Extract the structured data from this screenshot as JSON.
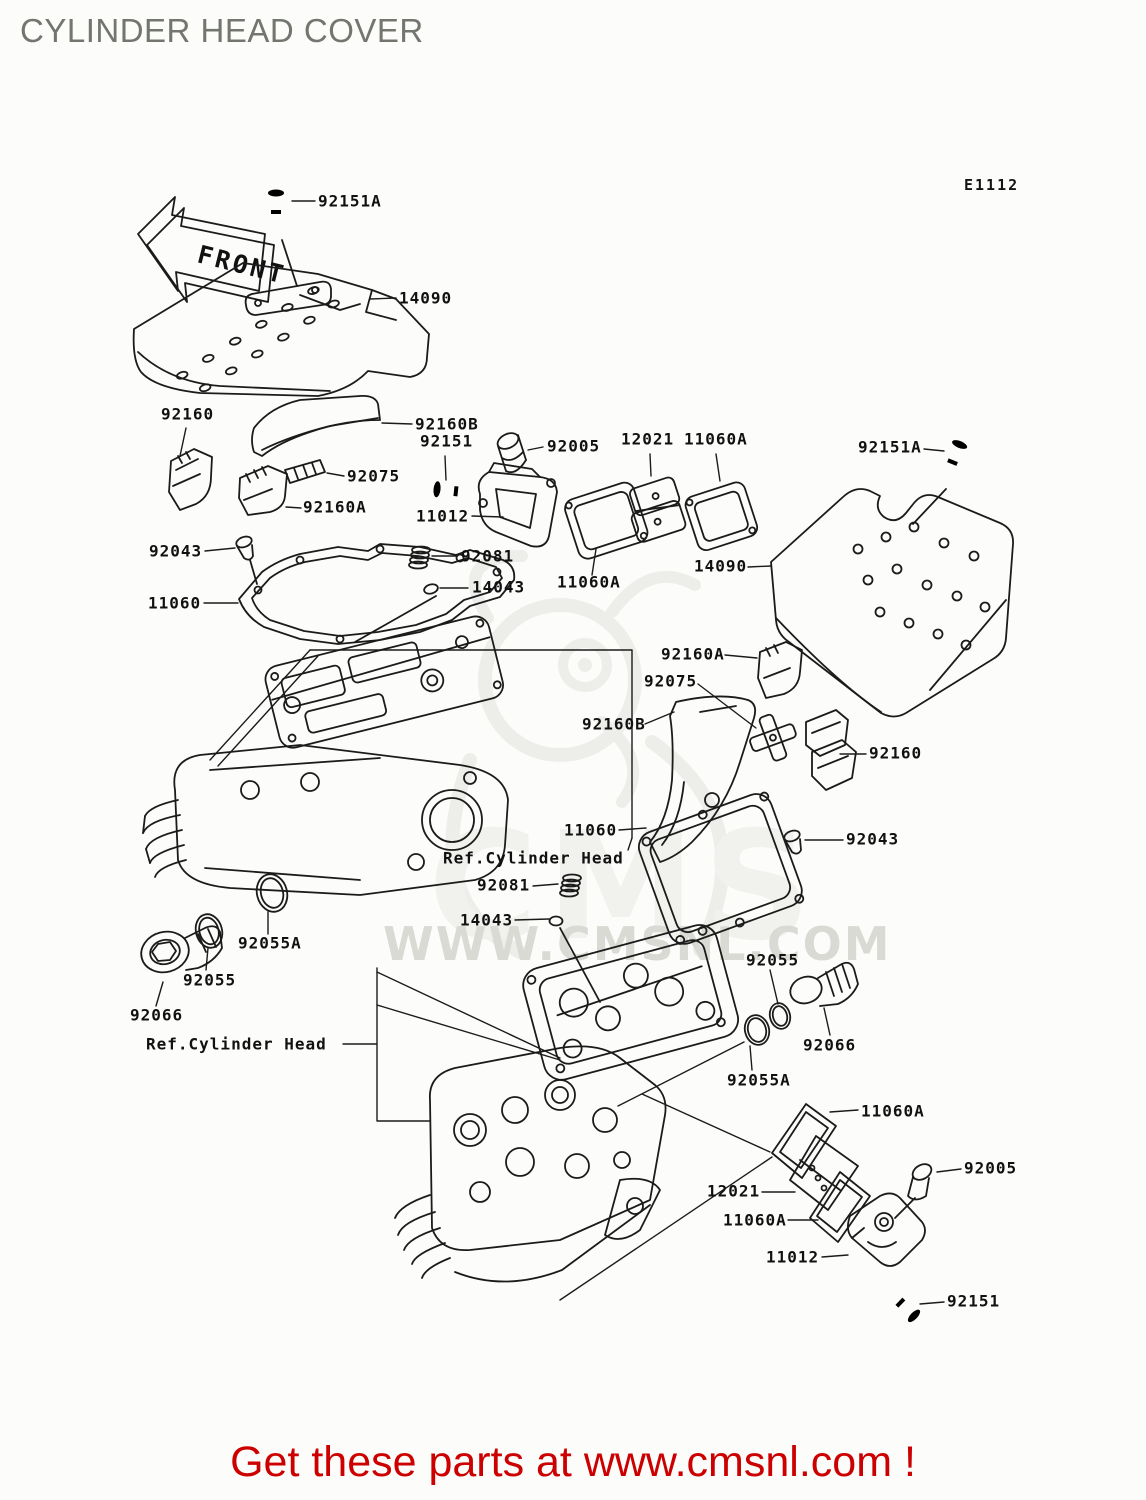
{
  "page": {
    "title": "CYLINDER HEAD COVER",
    "diagram_code": "E1112",
    "footer": "Get these parts at www.cmsnl.com !"
  },
  "front_arrow": {
    "label": "FRONT"
  },
  "watermark": {
    "band": "WWW.CMSNL.COM",
    "logo_text": "CMS"
  },
  "colors": {
    "line": "#1b1b1b",
    "title_gray": "#72766f",
    "footer_red": "#cc0000",
    "watermark_gray": "#dadad5",
    "background": "#fcfdfb"
  },
  "part_numbers_visible": [
    "11012",
    "11060",
    "11060A",
    "12021",
    "14043",
    "14090",
    "92005",
    "92043",
    "92055",
    "92055A",
    "92066",
    "92075",
    "92081",
    "92151",
    "92151A",
    "92160",
    "92160A",
    "92160B"
  ],
  "reference_note": "Ref.Cylinder Head",
  "labels": [
    {
      "text": "92151A",
      "x": 318,
      "y": 201
    },
    {
      "text": "14090",
      "x": 399,
      "y": 298
    },
    {
      "text": "92160",
      "x": 161,
      "y": 414
    },
    {
      "text": "92160B",
      "x": 415,
      "y": 424
    },
    {
      "text": "92151",
      "x": 420,
      "y": 441
    },
    {
      "text": "92005",
      "x": 547,
      "y": 446
    },
    {
      "text": "12021",
      "x": 621,
      "y": 439
    },
    {
      "text": "11060A",
      "x": 684,
      "y": 439
    },
    {
      "text": "92151A",
      "x": 858,
      "y": 447
    },
    {
      "text": "92075",
      "x": 347,
      "y": 476
    },
    {
      "text": "92160A",
      "x": 303,
      "y": 507
    },
    {
      "text": "11012",
      "x": 416,
      "y": 516
    },
    {
      "text": "92043",
      "x": 149,
      "y": 551
    },
    {
      "text": "92081",
      "x": 461,
      "y": 556
    },
    {
      "text": "14090",
      "x": 694,
      "y": 566
    },
    {
      "text": "11060A",
      "x": 557,
      "y": 582
    },
    {
      "text": "14043",
      "x": 472,
      "y": 587
    },
    {
      "text": "11060",
      "x": 148,
      "y": 603
    },
    {
      "text": "92160A",
      "x": 661,
      "y": 654
    },
    {
      "text": "92075",
      "x": 644,
      "y": 681
    },
    {
      "text": "92160B",
      "x": 582,
      "y": 724
    },
    {
      "text": "92160",
      "x": 869,
      "y": 753
    },
    {
      "text": "11060",
      "x": 564,
      "y": 830
    },
    {
      "text": "92043",
      "x": 846,
      "y": 839
    },
    {
      "text": "Ref.Cylinder Head",
      "x": 443,
      "y": 858
    },
    {
      "text": "92081",
      "x": 477,
      "y": 885
    },
    {
      "text": "14043",
      "x": 460,
      "y": 920
    },
    {
      "text": "92055A",
      "x": 238,
      "y": 943
    },
    {
      "text": "92055",
      "x": 183,
      "y": 980
    },
    {
      "text": "92066",
      "x": 130,
      "y": 1015
    },
    {
      "text": "Ref.Cylinder Head",
      "x": 146,
      "y": 1044
    },
    {
      "text": "92055",
      "x": 746,
      "y": 960
    },
    {
      "text": "92066",
      "x": 803,
      "y": 1045
    },
    {
      "text": "92055A",
      "x": 727,
      "y": 1080
    },
    {
      "text": "11060A",
      "x": 861,
      "y": 1111
    },
    {
      "text": "12021",
      "x": 707,
      "y": 1191
    },
    {
      "text": "11060A",
      "x": 723,
      "y": 1220
    },
    {
      "text": "11012",
      "x": 766,
      "y": 1257
    },
    {
      "text": "92005",
      "x": 964,
      "y": 1168
    },
    {
      "text": "92151",
      "x": 947,
      "y": 1301
    }
  ]
}
